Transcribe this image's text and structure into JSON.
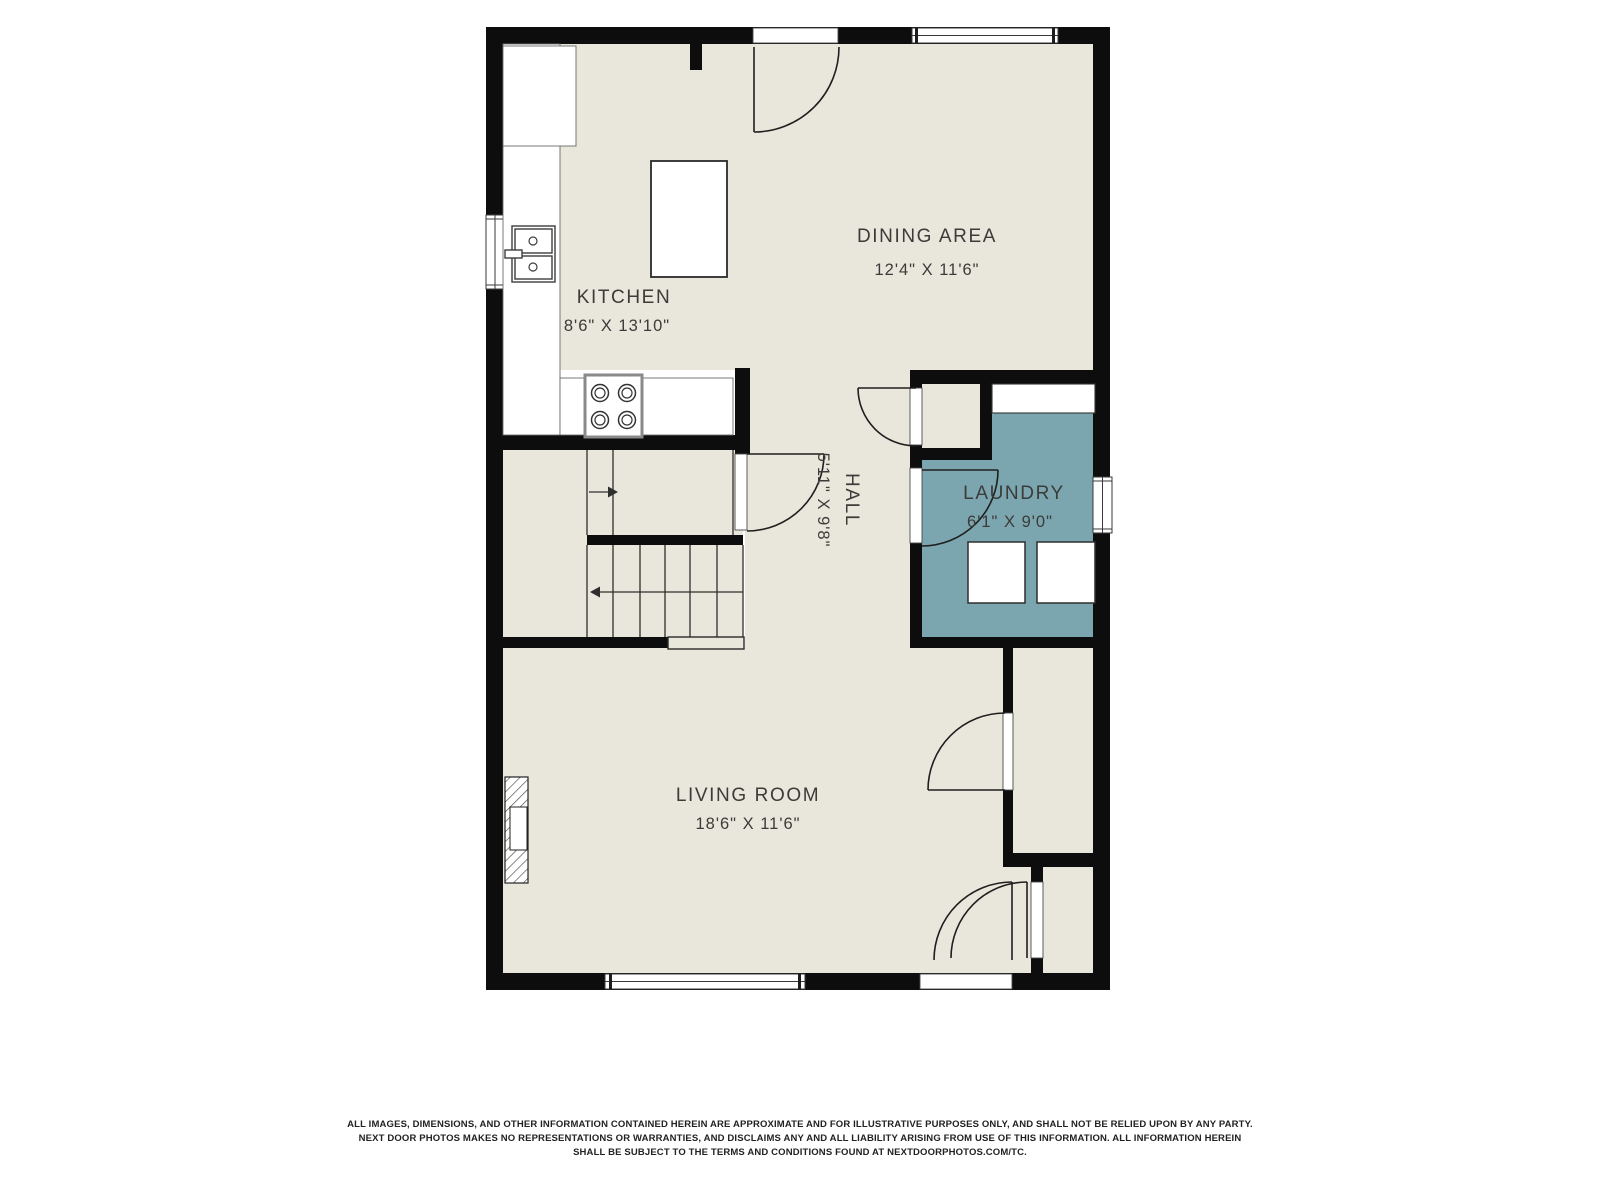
{
  "floor_plan": {
    "colors": {
      "floor": "#e9e7db",
      "laundry_floor": "#7ba6af",
      "wall": "#0d0d0d",
      "label_text": "#3b3b39"
    },
    "rooms": [
      {
        "id": "kitchen",
        "name": "KITCHEN",
        "dimensions": "8'6\" X 13'10\""
      },
      {
        "id": "dining",
        "name": "DINING AREA",
        "dimensions": "12'4\" X 11'6\""
      },
      {
        "id": "hall",
        "name": "HALL",
        "dimensions": "5'11\" X 9'8\""
      },
      {
        "id": "laundry",
        "name": "LAUNDRY",
        "dimensions": "6'1\" X 9'0\""
      },
      {
        "id": "living",
        "name": "LIVING ROOM",
        "dimensions": "18'6\" X 11'6\""
      }
    ],
    "fixtures": [
      "refrigerator",
      "kitchen-counter",
      "double-sink",
      "stove",
      "kitchen-island",
      "staircase",
      "stair-up-arrow",
      "stair-down-arrow",
      "fireplace",
      "laundry-counter",
      "washer",
      "dryer"
    ],
    "features": [
      "windows",
      "door-swings",
      "closet"
    ]
  },
  "disclaimer": {
    "line1": "ALL IMAGES, DIMENSIONS, AND OTHER INFORMATION CONTAINED HEREIN ARE APPROXIMATE AND FOR ILLUSTRATIVE PURPOSES ONLY, AND SHALL NOT BE RELIED UPON BY ANY PARTY.",
    "line2": "NEXT DOOR PHOTOS MAKES NO REPRESENTATIONS OR WARRANTIES, AND DISCLAIMS ANY AND ALL LIABILITY ARISING FROM USE OF THIS INFORMATION. ALL INFORMATION HEREIN",
    "line3": "SHALL BE SUBJECT TO THE TERMS AND CONDITIONS FOUND AT NEXTDOORPHOTOS.COM/TC."
  }
}
